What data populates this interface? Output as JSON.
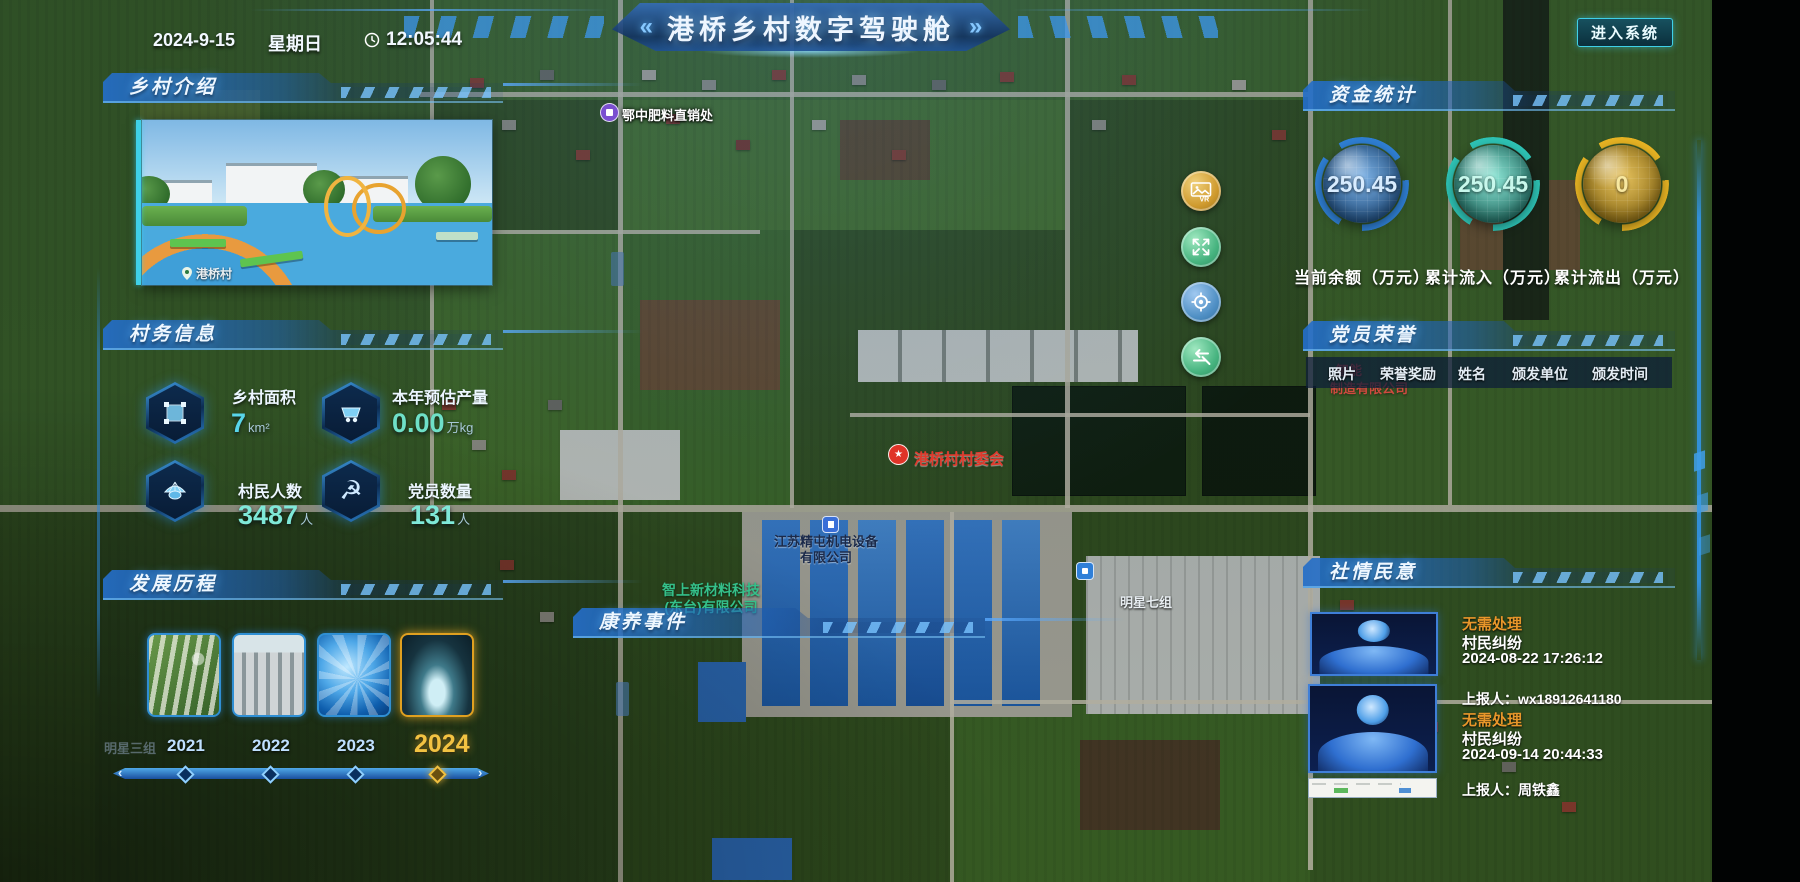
{
  "header": {
    "date": "2024-9-15",
    "weekday": "星期日",
    "time": "12:05:44",
    "title": "港桥乡村数字驾驶舱",
    "chevron_left": "«",
    "chevron_right": "»",
    "enter_button": "进入系统"
  },
  "village_intro": {
    "title": "乡村介绍",
    "photo_caption": "港桥村"
  },
  "village_info": {
    "title": "村务信息",
    "stats": [
      {
        "icon": "area-select-icon",
        "label": "乡村面积",
        "value": "7",
        "unit": "km²"
      },
      {
        "icon": "mine-cart-icon",
        "label": "本年预估产量",
        "value": "0.00",
        "unit": "万kg"
      },
      {
        "icon": "farmer-hat-icon",
        "label": "村民人数",
        "value": "3487",
        "unit": "人"
      },
      {
        "icon": "party-emblem-icon",
        "label": "党员数量",
        "value": "131",
        "unit": "人"
      }
    ]
  },
  "development": {
    "title": "发展历程",
    "years": [
      "2021",
      "2022",
      "2023",
      "2024"
    ],
    "selected_year": "2024"
  },
  "funds": {
    "title": "资金统计",
    "gauges": [
      {
        "value": "250.45",
        "label": "当前余额（万元）",
        "color": "#2f7fd4"
      },
      {
        "value": "250.45",
        "label": "累计流入（万元）",
        "color": "#2ec4b6"
      },
      {
        "value": "0",
        "label": "累计流出（万元）",
        "color": "#e8b423"
      }
    ]
  },
  "party_honor": {
    "title": "党员荣誉",
    "columns": [
      "照片",
      "荣誉奖励",
      "姓名",
      "颁发单位",
      "颁发时间"
    ]
  },
  "sentiment": {
    "title": "社情民意",
    "items": [
      {
        "status": "无需处理",
        "category": "村民纠纷",
        "datetime": "2024-08-22 17:26:12",
        "reporter": "上报人：wx18912641180"
      },
      {
        "status": "无需处理",
        "category": "村民纠纷",
        "datetime": "2024-09-14 20:44:33",
        "reporter": "上报人：周铁鑫"
      }
    ]
  },
  "health_events": {
    "title": "康养事件"
  },
  "map": {
    "labels": {
      "fertilizer_store": "鄂中肥料直销处",
      "village_committee": "港桥村村委会",
      "company1_line1": "江苏精屯机电设备",
      "company1_line2": "有限公司",
      "company2_line1": "智上新材料科技",
      "company2_line2": "(东台)有限公司",
      "company3_line1": "智能",
      "company3_line2": "制造有限公司",
      "group_seven": "明星七组",
      "group_three": "明星三组"
    },
    "controls": {
      "vr_label": "VR"
    }
  }
}
